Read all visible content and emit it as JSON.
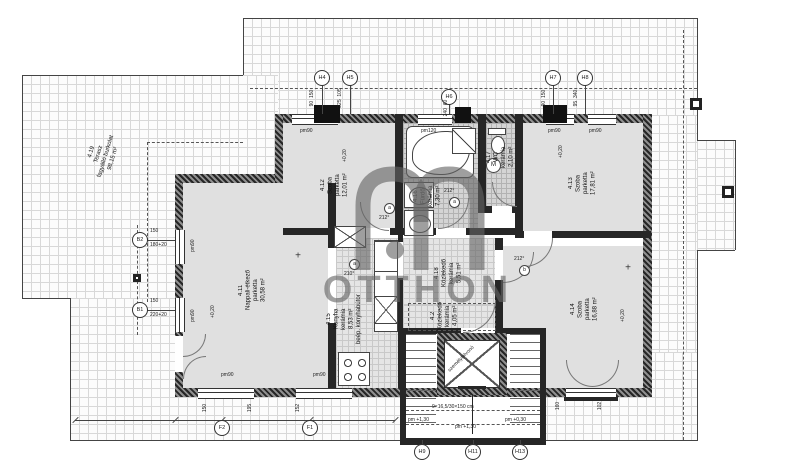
{
  "watermark": {
    "text": "OTTHON"
  },
  "rooms": [
    {
      "id": "4.11",
      "name": "Nappali-étkező",
      "material": "parketta",
      "area": "30,58 m²"
    },
    {
      "id": "4.12",
      "name": "Szoba",
      "material": "parketta",
      "area": "12,01 m²"
    },
    {
      "id": "4.13",
      "name": "Szoba",
      "material": "parketta",
      "area": "17,81 m²"
    },
    {
      "id": "4.14",
      "name": "Szoba",
      "material": "parketta",
      "area": "16,88 m²"
    },
    {
      "id": "4.15",
      "name": "Konyha",
      "material": "kerámia",
      "area": "8,53 m²",
      "note": "beép. konyhabútor"
    },
    {
      "id": "4.16",
      "name": "Fürdő",
      "material": "kerámia",
      "area": "7,30 m²"
    },
    {
      "id": "4.17",
      "name": "WC",
      "material": "kerámia",
      "area": "2,10 m²"
    },
    {
      "id": "4.18",
      "name": "Közlekedő",
      "material": "kerámia",
      "area": "5,51 m²"
    },
    {
      "id": "4.2",
      "name": "Közlekedő",
      "material": "kerámia",
      "area": "4,05 m²"
    },
    {
      "id": "4.19",
      "name": "Terasz",
      "material": "fagyálló burkolat",
      "area": "98,15 m²"
    }
  ],
  "annotations": [
    {
      "t": "bubble",
      "x": 322,
      "y": 78,
      "text": "H4"
    },
    {
      "t": "bubble",
      "x": 350,
      "y": 78,
      "text": "H5"
    },
    {
      "t": "bubble",
      "x": 449,
      "y": 97,
      "text": "H6"
    },
    {
      "t": "bubble",
      "x": 553,
      "y": 78,
      "text": "H7"
    },
    {
      "t": "bubble",
      "x": 585,
      "y": 78,
      "text": "H8"
    },
    {
      "t": "bubble",
      "x": 140,
      "y": 240,
      "text": "B2"
    },
    {
      "t": "bubble",
      "x": 140,
      "y": 310,
      "text": "B1"
    },
    {
      "t": "bubble",
      "x": 222,
      "y": 428,
      "text": "F2"
    },
    {
      "t": "bubble",
      "x": 310,
      "y": 428,
      "text": "F1"
    },
    {
      "t": "bubble",
      "x": 422,
      "y": 452,
      "text": "H9"
    },
    {
      "t": "bubble",
      "x": 473,
      "y": 452,
      "text": "H11"
    },
    {
      "t": "bubble",
      "x": 520,
      "y": 452,
      "text": "H13"
    },
    {
      "t": "dim",
      "x": 312,
      "y": 98,
      "text": "90  150"
    },
    {
      "t": "dim",
      "x": 340,
      "y": 98,
      "text": "225  105"
    },
    {
      "t": "dim",
      "x": 446,
      "y": 108,
      "text": "240  60"
    },
    {
      "t": "dim",
      "x": 544,
      "y": 98,
      "text": "90  150"
    },
    {
      "t": "dim",
      "x": 576,
      "y": 98,
      "text": "95  340"
    },
    {
      "t": "dim",
      "x": 205,
      "y": 408,
      "text": "150"
    },
    {
      "t": "dim",
      "x": 250,
      "y": 408,
      "text": "195"
    },
    {
      "t": "dim",
      "x": 298,
      "y": 408,
      "text": "152"
    },
    {
      "t": "dim",
      "x": 558,
      "y": 406,
      "text": "160"
    },
    {
      "t": "dim",
      "x": 600,
      "y": 406,
      "text": "102"
    },
    {
      "t": "dimh",
      "x": 150,
      "y": 228,
      "text": "150"
    },
    {
      "t": "dimh",
      "x": 150,
      "y": 242,
      "text": "180+20"
    },
    {
      "t": "dimh",
      "x": 150,
      "y": 298,
      "text": "150"
    },
    {
      "t": "dimh",
      "x": 150,
      "y": 312,
      "text": "220+20"
    },
    {
      "t": "pm",
      "x": 300,
      "y": 128,
      "text": "pm90"
    },
    {
      "t": "pm",
      "x": 421,
      "y": 128,
      "text": "pm120"
    },
    {
      "t": "pm",
      "x": 548,
      "y": 128,
      "text": "pm90"
    },
    {
      "t": "pm",
      "x": 589,
      "y": 128,
      "text": "pm90"
    },
    {
      "t": "pm",
      "x": 221,
      "y": 372,
      "text": "pm90"
    },
    {
      "t": "pm",
      "x": 313,
      "y": 372,
      "text": "pm90"
    },
    {
      "t": "pmv",
      "x": 190,
      "y": 252,
      "text": "pm90"
    },
    {
      "t": "pmv",
      "x": 190,
      "y": 322,
      "text": "pm90"
    },
    {
      "t": "ev",
      "x": 210,
      "y": 318,
      "text": "+0,20"
    },
    {
      "t": "ev",
      "x": 342,
      "y": 162,
      "text": "+0,20"
    },
    {
      "t": "ev",
      "x": 558,
      "y": 158,
      "text": "+0,20"
    },
    {
      "t": "ev",
      "x": 620,
      "y": 322,
      "text": "+0,20"
    },
    {
      "t": "deg",
      "x": 384,
      "y": 203,
      "text": "a"
    },
    {
      "t": "note",
      "x": 379,
      "y": 215,
      "text": "212°"
    },
    {
      "t": "deg",
      "x": 349,
      "y": 259,
      "text": "a"
    },
    {
      "t": "note",
      "x": 344,
      "y": 271,
      "text": "210°"
    },
    {
      "t": "deg",
      "x": 519,
      "y": 265,
      "text": "b"
    },
    {
      "t": "note",
      "x": 514,
      "y": 256,
      "text": "212°"
    },
    {
      "t": "deg",
      "x": 449,
      "y": 197,
      "text": "a"
    },
    {
      "t": "note",
      "x": 444,
      "y": 188,
      "text": "212°"
    },
    {
      "t": "plus",
      "x": 298,
      "y": 256,
      "text": "+"
    },
    {
      "t": "plus",
      "x": 628,
      "y": 268,
      "text": "+"
    },
    {
      "t": "note",
      "x": 432,
      "y": 404,
      "text": "9×16,5/30×150 cm"
    },
    {
      "t": "note",
      "x": 408,
      "y": 417,
      "text": "pm +1,30"
    },
    {
      "t": "note",
      "x": 455,
      "y": 424,
      "text": "pm +1,30"
    },
    {
      "t": "note",
      "x": 505,
      "y": 417,
      "text": "pm +0,30"
    },
    {
      "t": "diag",
      "x": 444,
      "y": 356,
      "text": "személyfelvonó"
    }
  ]
}
